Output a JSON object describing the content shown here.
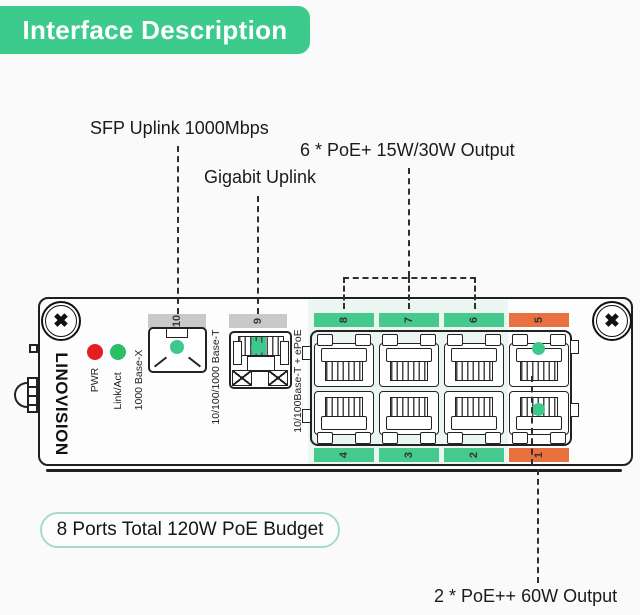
{
  "header": {
    "title": "Interface Description"
  },
  "callouts": {
    "sfp": "SFP Uplink 1000Mbps",
    "gigabit": "Gigabit Uplink",
    "poe6": "6 * PoE+ 15W/30W Output",
    "poe2": "2 * PoE++ 60W Output",
    "budget": "8 Ports Total 120W PoE Budget"
  },
  "device": {
    "brand": "LINOVISION",
    "leds": [
      {
        "name": "PWR",
        "color": "#e41e1e"
      },
      {
        "name": "Link/Act",
        "color": "#29bf63"
      }
    ],
    "port_type_labels": {
      "sfp": "1000 Base-X",
      "uplink": "10/100/1000 Base-T",
      "poe": "10/100Base-T + ePoE"
    },
    "uplink_ports": [
      {
        "number": "10",
        "color": "#c9c9c9"
      },
      {
        "number": "9",
        "color": "#c9c9c9"
      }
    ],
    "poe_ports_top": [
      {
        "number": "8",
        "color": "#45c98c"
      },
      {
        "number": "7",
        "color": "#45c98c"
      },
      {
        "number": "6",
        "color": "#45c98c"
      },
      {
        "number": "5",
        "color": "#e8713f"
      }
    ],
    "poe_ports_bottom": [
      {
        "number": "4",
        "color": "#45c98c"
      },
      {
        "number": "3",
        "color": "#45c98c"
      },
      {
        "number": "2",
        "color": "#45c98c"
      },
      {
        "number": "1",
        "color": "#e8713f"
      }
    ]
  },
  "icons": {
    "screw": "✖"
  },
  "colors": {
    "brand_green": "#3ccb8d",
    "port_green": "#45c98c",
    "port_orange": "#e8713f",
    "tint_green": "#eaf6ef",
    "gray_bar": "#c9c9c9",
    "indicator_green": "#3dc98b",
    "pill_border": "#a6dcc6",
    "background": "#fafafa"
  }
}
